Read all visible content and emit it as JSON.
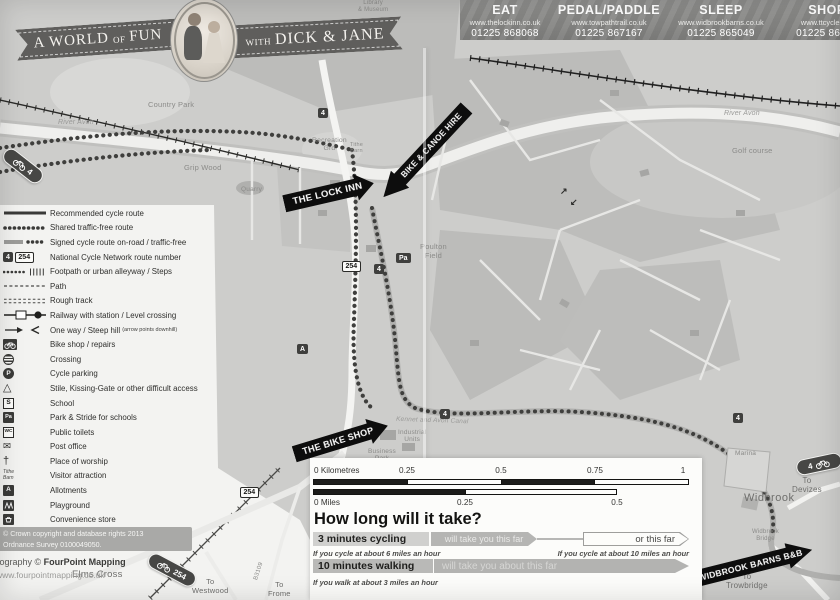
{
  "banner": {
    "part1": "A WORLD",
    "part2": "OF",
    "part3": "FUN",
    "part4": "WITH",
    "part5": "DICK & JANE"
  },
  "header": {
    "columns": [
      {
        "title": "EAT",
        "site": "www.thelockinn.co.uk",
        "phone": "01225 868068"
      },
      {
        "title": "PEDAL/PADDLE",
        "site": "www.towpathtrail.co.uk",
        "phone": "01225 867167"
      },
      {
        "title": "SLEEP",
        "site": "www.widbrookbarns.co.uk",
        "phone": "01225 865049"
      },
      {
        "title": "SHOP",
        "site": "www.ttcycles.co",
        "phone": "01225 86718"
      }
    ]
  },
  "legend": {
    "items": [
      {
        "label": "Recommended cycle route"
      },
      {
        "label": "Shared traffic-free route"
      },
      {
        "label": "Signed cycle route on-road / traffic-free"
      },
      {
        "label": "National Cycle Network route number",
        "g1": "4",
        "g2": "254"
      },
      {
        "label": "Footpath or urban alleyway / Steps"
      },
      {
        "label": "Path"
      },
      {
        "label": "Rough track"
      },
      {
        "label": "Railway with station / Level crossing"
      },
      {
        "label": "One way / Steep hill",
        "note": "(arrow points downhill)"
      },
      {
        "label": "Bike shop / repairs"
      },
      {
        "label": "Crossing"
      },
      {
        "label": "Cycle parking",
        "g1": "P"
      },
      {
        "label": "Stile, Kissing-Gate or other difficult access",
        "g1": "△"
      },
      {
        "label": "School",
        "g1": "S"
      },
      {
        "label": "Park & Stride for schools",
        "g1": "Pa"
      },
      {
        "label": "Public toilets",
        "g1": "WC"
      },
      {
        "label": "Post office",
        "g1": "✉"
      },
      {
        "label": "Place of worship",
        "g1": "†"
      },
      {
        "label": "Visitor attraction",
        "g1": "Tithe\nBarn"
      },
      {
        "label": "Allotments",
        "g1": "A"
      },
      {
        "label": "Playground"
      },
      {
        "label": "Convenience store"
      },
      {
        "label": "Borough boundary"
      }
    ]
  },
  "map": {
    "labels": [
      {
        "text": "Country Park"
      },
      {
        "text": "Grip Wood"
      },
      {
        "text": "Quarry"
      },
      {
        "text": "Recreation\nGrd"
      },
      {
        "text": "River Avon"
      },
      {
        "text": "River Avon"
      },
      {
        "text": "Golf course"
      },
      {
        "text": "Poulton\nField"
      },
      {
        "text": "Kennet and Avon Canal"
      },
      {
        "text": "Industrial\nUnits"
      },
      {
        "text": "Business\nPark"
      },
      {
        "text": "Marina"
      },
      {
        "text": "Widbrook"
      },
      {
        "text": "Widbrook\nBridge"
      },
      {
        "text": "To\nDevizes"
      },
      {
        "text": "To\nTrowbridge"
      },
      {
        "text": "Elms Cross"
      },
      {
        "text": "To\nWestwood"
      },
      {
        "text": "To\nFrome"
      },
      {
        "text": "B3109"
      },
      {
        "text": "Tithe\nBarn"
      },
      {
        "text": "Library\n& Museum"
      }
    ],
    "arrows": [
      {
        "text": "THE LOCK INN"
      },
      {
        "text": "BIKE & CANOE HIRE"
      },
      {
        "text": "THE BIKE SHOP"
      },
      {
        "text": "WIDBROOK BARNS B&B"
      }
    ],
    "badges": {
      "n4": "4",
      "n254": "254",
      "pa": "Pa",
      "a": "A"
    },
    "oneway_up": "↗",
    "oneway_down": "↙"
  },
  "scale": {
    "km_label": "0  Kilometres",
    "km_ticks": [
      "0.25",
      "0.5",
      "0.75",
      "1"
    ],
    "mi_label": "0  Miles",
    "mi_ticks": [
      "0.25",
      "0.5"
    ]
  },
  "timing": {
    "title": "How long will it take?",
    "row1": {
      "label": "3 minutes cycling",
      "mid": "will take you this far",
      "right": "or this far",
      "note_left": "If you cycle at about 6 miles an hour",
      "note_right": "If you cycle at about 10 miles an hour"
    },
    "row2": {
      "label": "10 minutes walking",
      "mid": "will take you about this far",
      "note": "If you walk at about 3 miles an hour"
    }
  },
  "credits": {
    "line1": "© Crown copyright and database rights 2013",
    "line2": "Ordnance Survey 0100049050.",
    "cart_prefix": "tography © ",
    "cart_name": "FourPoint Mapping",
    "website": "www.fourpointmapping.co.uk"
  },
  "colors": {
    "arrow_black": "#0d0d0d",
    "ribbon_gray": "#5f5e5c",
    "header_gray": "#8d8d8b",
    "map_gray": "#cdcdcb",
    "housing_gray": "#bcbcba"
  }
}
